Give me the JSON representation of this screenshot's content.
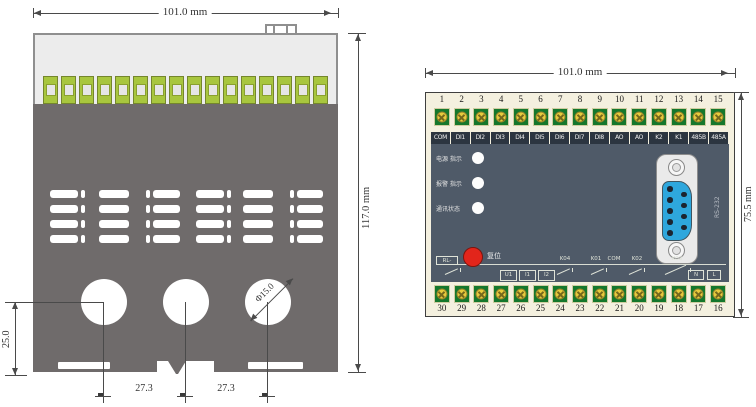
{
  "drawing": {
    "left_view": {
      "title": "device-outline-with-mounting-dimensions",
      "width_dim": "101.0 mm",
      "height_dim": "117.0 mm",
      "hole_offset_dim": "25.0",
      "hole_spacing_dim_1": "27.3",
      "hole_spacing_dim_2": "27.3",
      "hole_diameter_dim": "Φ15.0",
      "terminal_count": 16,
      "vent_rows": 4,
      "mounting_hole_count": 3
    },
    "right_view": {
      "title": "terminal-panel-layout",
      "width_dim": "101.0 mm",
      "height_dim": "75.5 mm",
      "top_terminal_numbers": [
        "1",
        "2",
        "3",
        "4",
        "5",
        "6",
        "7",
        "8",
        "9",
        "10",
        "11",
        "12",
        "13",
        "14",
        "15"
      ],
      "top_terminal_labels": [
        "COM",
        "DI1",
        "DI2",
        "DI3",
        "DI4",
        "DI5",
        "DI6",
        "DI7",
        "DI8",
        "AO",
        "AO",
        "K2",
        "K1",
        "485B",
        "485A"
      ],
      "bottom_terminal_numbers": [
        "30",
        "29",
        "28",
        "27",
        "26",
        "25",
        "24",
        "23",
        "22",
        "21",
        "20",
        "19",
        "18",
        "17",
        "16"
      ],
      "led_labels": [
        "电源 指示",
        "报警 指示",
        "通讯状态"
      ],
      "reset_button_label": "复位",
      "serial_port_label": "RS-232",
      "schematic": {
        "left_label": "RL-",
        "input_boxes": [
          "U1",
          "I1",
          "I2"
        ],
        "relay_labels": [
          "K04",
          "K01",
          "COM",
          "K02",
          "K03"
        ],
        "power_boxes": [
          "N",
          "L"
        ]
      }
    },
    "colors": {
      "body_light": "#ececec",
      "body_dark": "#6f6b6b",
      "terminal_block_green": "#a8c63e",
      "panel_cream": "#f4f0df",
      "panel_slate": "#4f5a68",
      "terminal_green": "#15772c",
      "screw_yellow": "#e7cb3d",
      "db9_blue": "#2ea7dd",
      "reset_red": "#e2251b",
      "label_strip_dark": "#2c3540"
    }
  }
}
